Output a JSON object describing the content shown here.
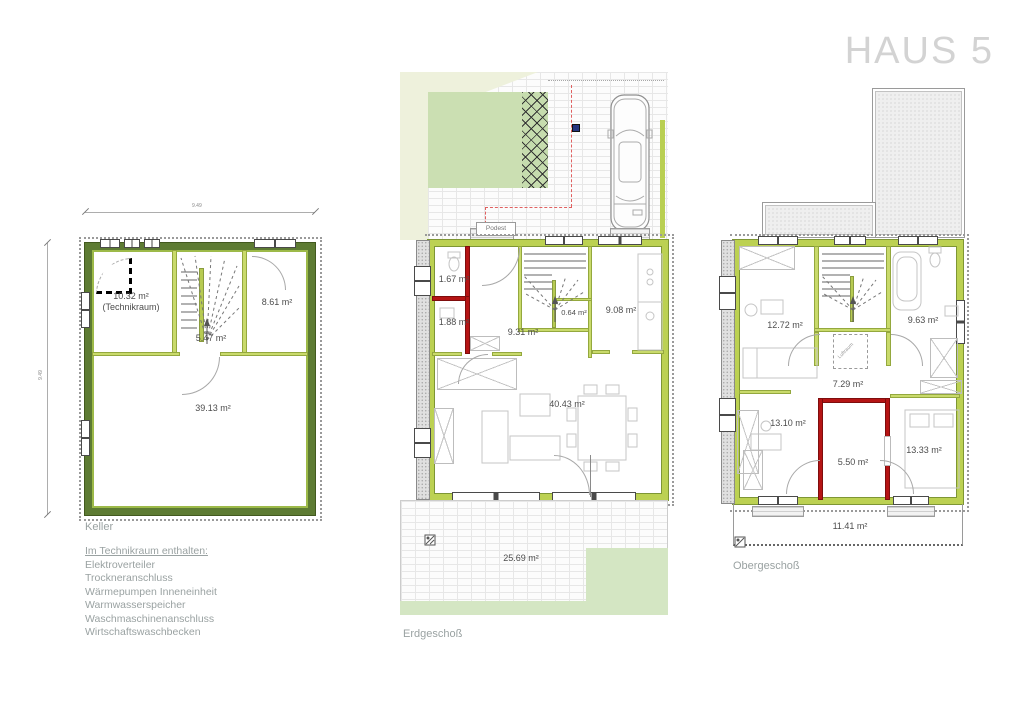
{
  "title": "HAUS 5",
  "colors": {
    "wall_dark_green": "#5d7b33",
    "wall_light_green": "#bcd152",
    "wall_red": "#b51414",
    "lawn": "#d4e6c3",
    "title_gray": "#d3d3d3",
    "label_gray": "#9aa2a2",
    "room_text": "#4d4d4d"
  },
  "keller": {
    "label": "Keller",
    "dim_w": "9.49",
    "dim_h": "9.49",
    "room_technik": "10.32 m²",
    "room_technik_sub": "(Technikraum)",
    "room_nebenraum": "8.61 m²",
    "room_flur": "5.47 m²",
    "room_haupt": "39.13 m²",
    "notes_title": "Im Technikraum enthalten:",
    "notes": [
      "Elektroverteiler",
      "Trockneranschluss",
      "Wärmepumpen Inneneinheit",
      "Warmwasserspeicher",
      "Waschmaschinenanschluss",
      "Wirtschaftswaschbecken"
    ]
  },
  "erdgeschoss": {
    "label": "Erdgeschoß",
    "podest": "Podest",
    "wc": "1.67 m²",
    "abstellraum": "1.88 m²",
    "flur": "9.31 m²",
    "nische": "0.64 m²",
    "kueche": "9.08 m²",
    "wohnen": "40.43 m²",
    "terrasse": "25.69 m²"
  },
  "obergeschoss": {
    "label": "Obergeschoß",
    "zimmer_links": "12.72 m²",
    "bad": "9.63 m²",
    "flur": "7.29 m²",
    "zimmer_unten_links": "13.10 m²",
    "ankleide": "5.50 m²",
    "zimmer_unten_rechts": "13.33 m²",
    "balkon": "11.41 m²",
    "void_label": "Luftraum"
  }
}
